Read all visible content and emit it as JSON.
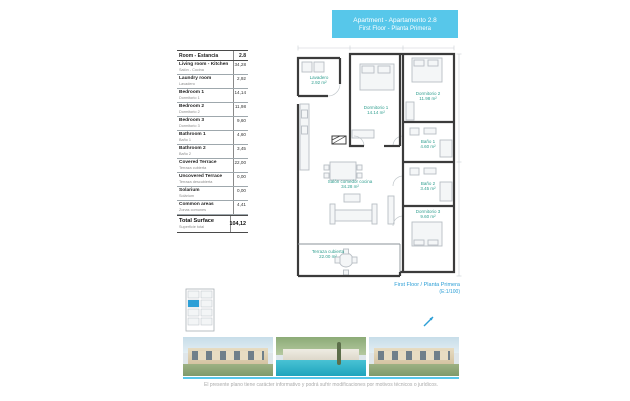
{
  "title_band": {
    "line1": "Apartment - Apartamento 2.8",
    "line2": "First Floor - Planta Primera"
  },
  "area_table": {
    "header": {
      "label": "Room - Estancia",
      "value": "2.8"
    },
    "rows": [
      {
        "label": "Living room - Kitchen",
        "sublabel": "Salón - Cocina",
        "value": "34,28"
      },
      {
        "label": "Laundry room",
        "sublabel": "Lavadero",
        "value": "2,92"
      },
      {
        "label": "Bedroom 1",
        "sublabel": "Dormitorio 1",
        "value": "14,14"
      },
      {
        "label": "Bedroom 2",
        "sublabel": "Dormitorio 2",
        "value": "11,98"
      },
      {
        "label": "Bedroom 3",
        "sublabel": "Dormitorio 3",
        "value": "9,60"
      },
      {
        "label": "Bathroom 1",
        "sublabel": "Baño 1",
        "value": "4,60"
      },
      {
        "label": "Bathroom 2",
        "sublabel": "Baño 2",
        "value": "3,45"
      },
      {
        "label": "Covered Terrace",
        "sublabel": "Terraza cubierta",
        "value": "22,00"
      },
      {
        "label": "Uncovered Terrace",
        "sublabel": "Terraza descubierta",
        "value": "0,00"
      },
      {
        "label": "Solarium",
        "sublabel": "Solárium",
        "value": "0,00"
      },
      {
        "label": "Common areas",
        "sublabel": "Zonas comunes",
        "value": "4,41"
      }
    ],
    "total": {
      "label": "Total Surface",
      "sublabel": "Superficie total",
      "value": "104,12"
    }
  },
  "plan": {
    "rooms": [
      {
        "name": "Lavadero",
        "area": "2.92 m²"
      },
      {
        "name": "Dormitorio 1",
        "area": "14.14 m²"
      },
      {
        "name": "Dormitorio 2",
        "area": "11.98 m²"
      },
      {
        "name": "Baño 1",
        "area": "4.60 m²"
      },
      {
        "name": "Baño 2",
        "area": "3.45 m²"
      },
      {
        "name": "Dormitorio 3",
        "area": "9.60 m²"
      },
      {
        "name": "Salón comedor cocina",
        "area": "34.28 m²"
      },
      {
        "name": "Terraza cubierta",
        "area": "22.00 m²"
      }
    ],
    "caption_line1": "First Floor / Planta Primera",
    "caption_line2": "(E:1/100)"
  },
  "footer": {
    "disclaimer": "El presente plano tiene carácter informativo y podrá sufrir modificaciones por motivos técnicos o jurídicos."
  },
  "colors": {
    "accent_cyan": "#57c7ea",
    "accent_blue": "#2d9fd6",
    "room_label_teal": "#2f9e8f"
  }
}
